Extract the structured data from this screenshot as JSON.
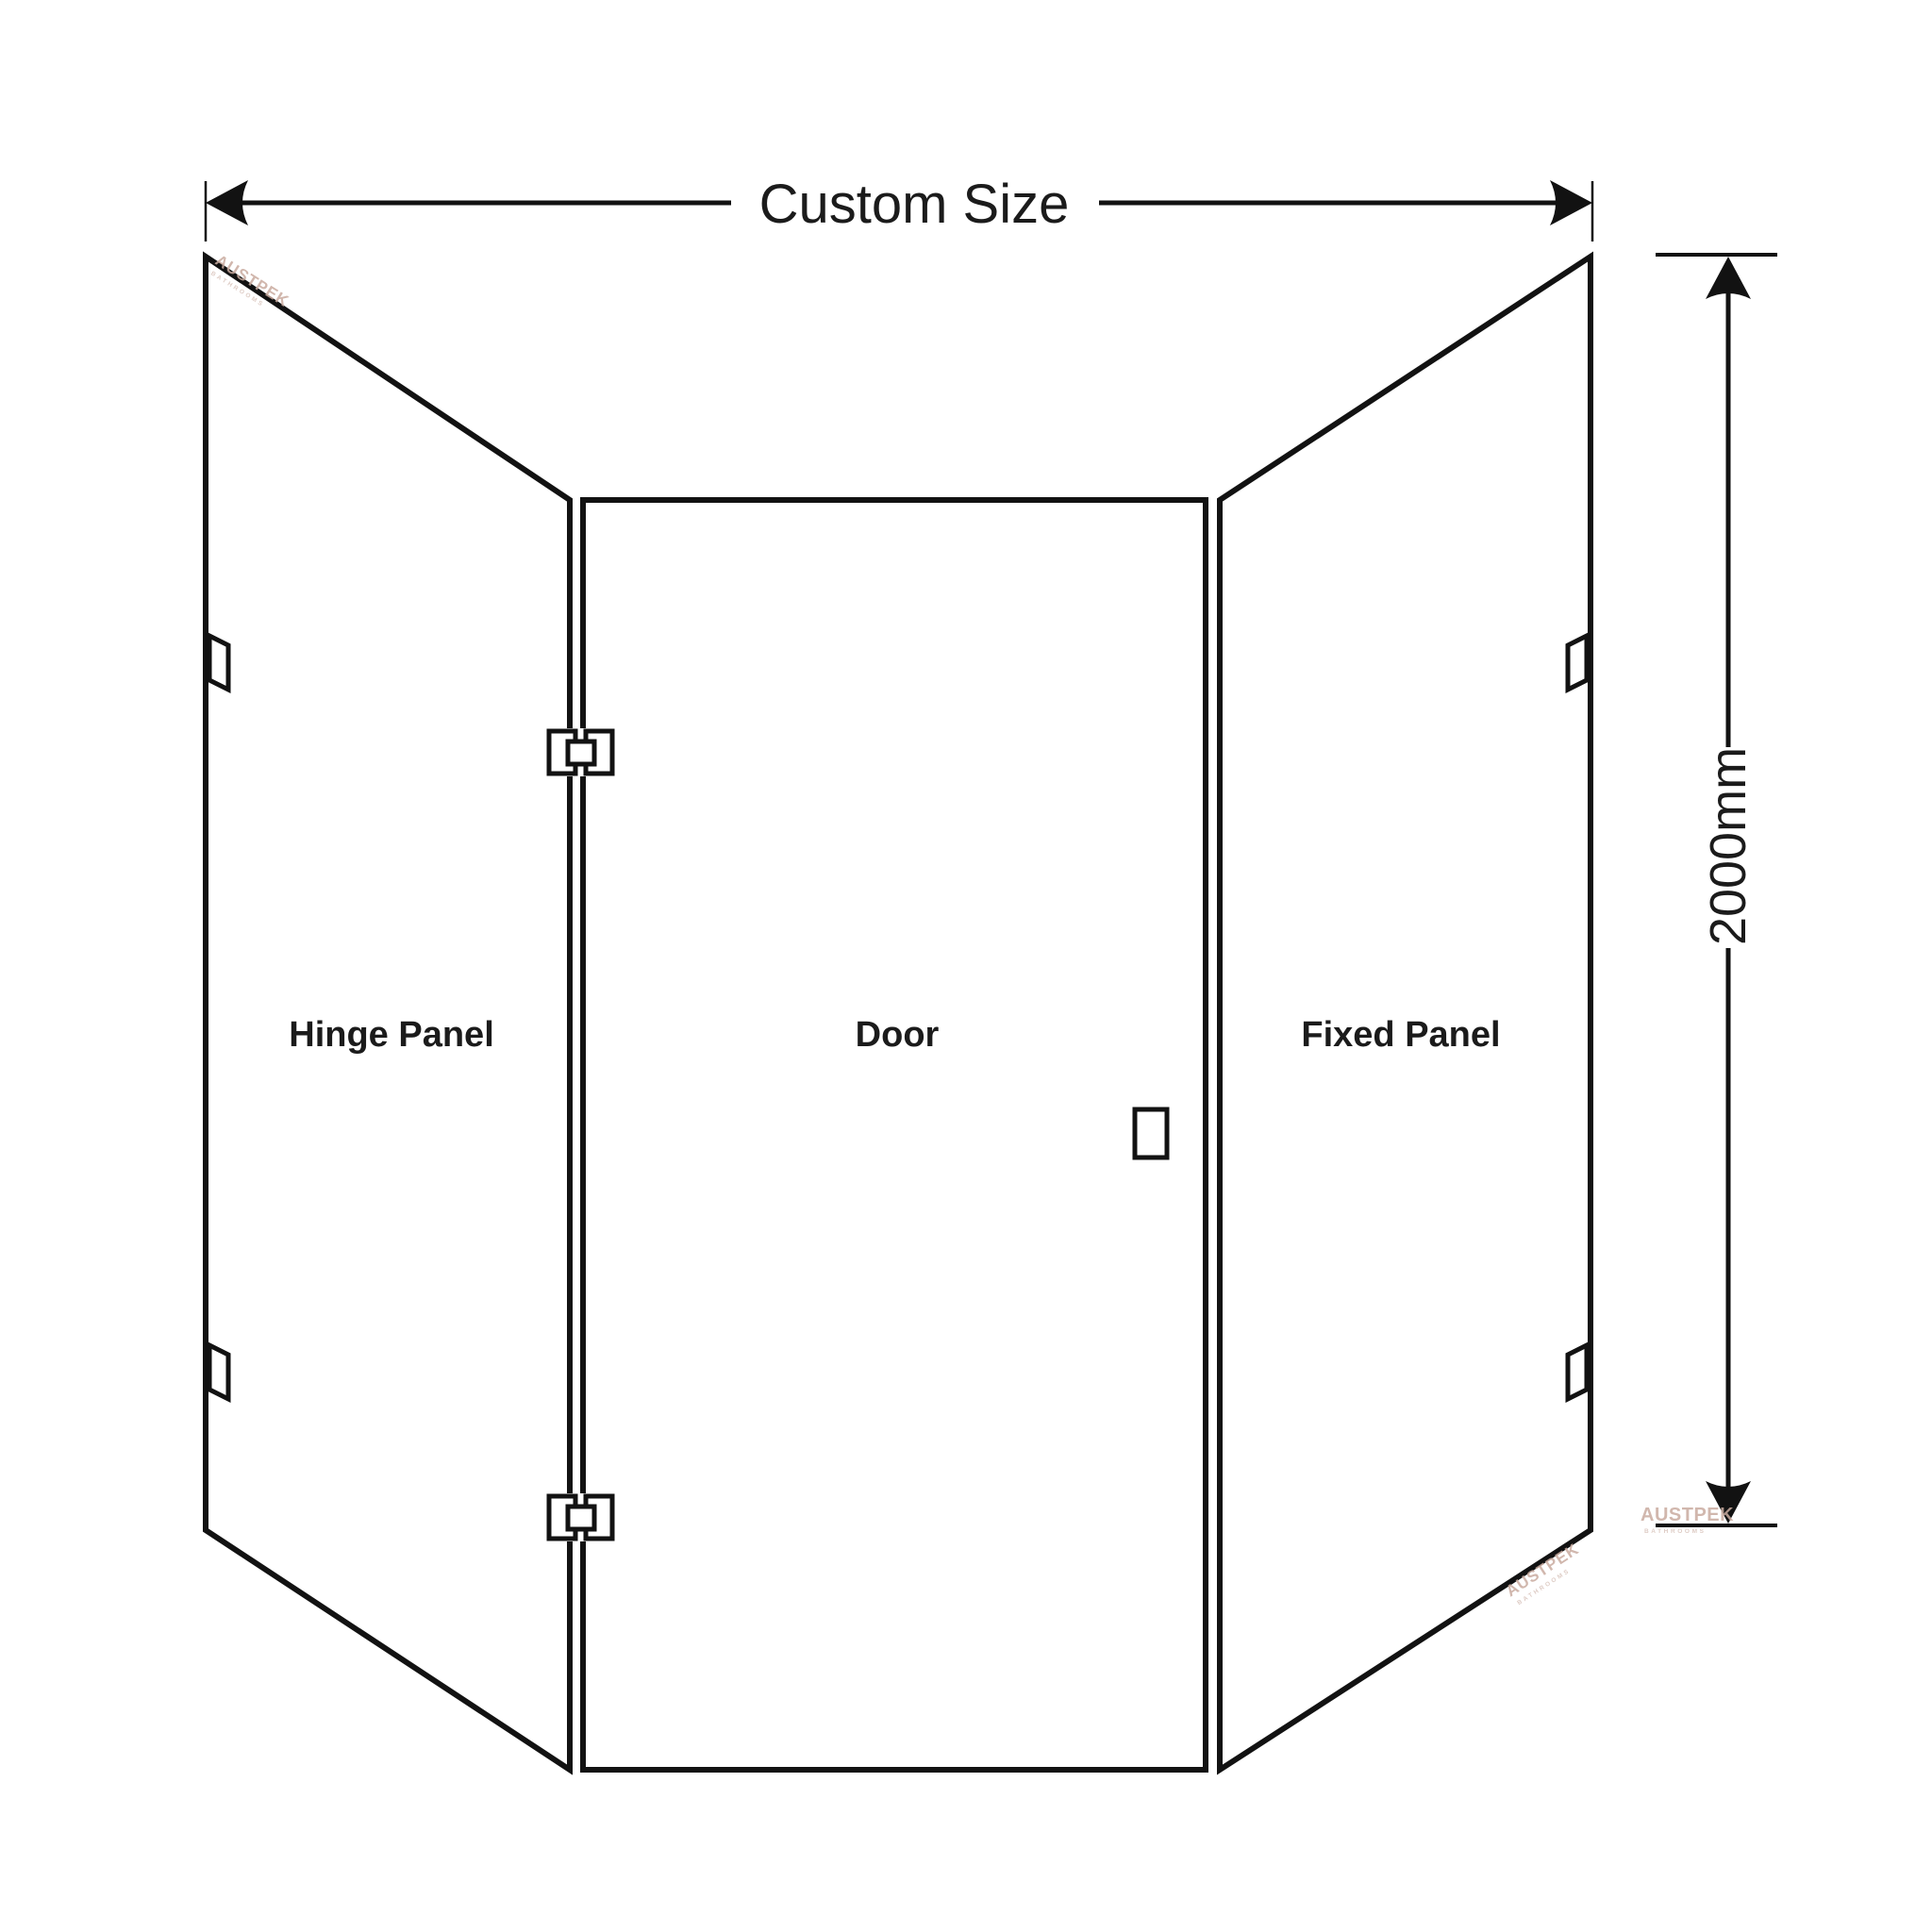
{
  "dimensions": {
    "width_label": "Custom Size",
    "height_label": "2000mm"
  },
  "panels": {
    "hinge": "Hinge Panel",
    "door": "Door",
    "fixed": "Fixed Panel"
  },
  "watermark": {
    "brand": "AUSTPEK",
    "sub": "BATHROOMS"
  },
  "colors": {
    "line": "#121212",
    "watermark": "#c9ab9f",
    "background": "#ffffff"
  }
}
